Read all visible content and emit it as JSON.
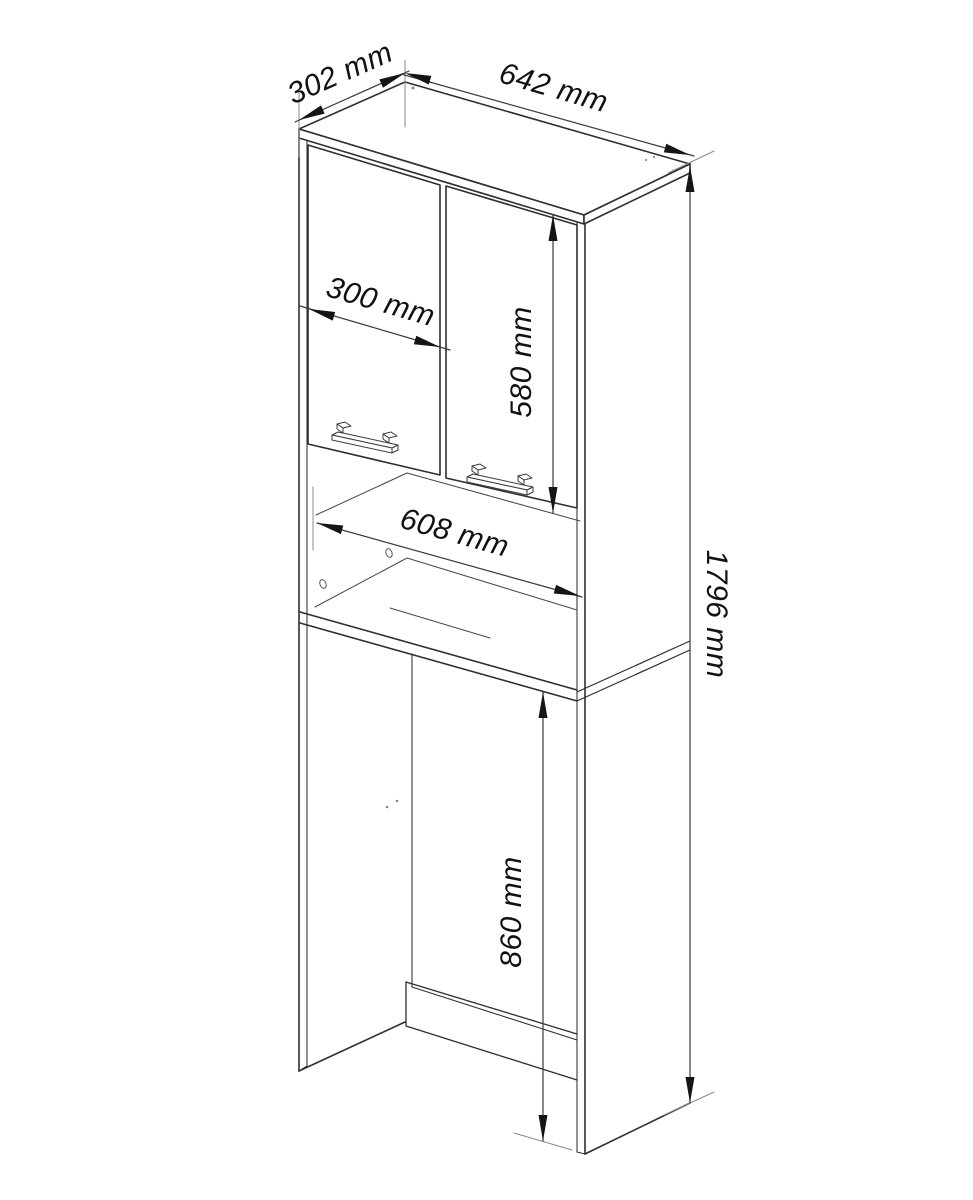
{
  "page": {
    "background": "#ffffff"
  },
  "drawing": {
    "type": "furniture-technical-drawing",
    "subject": "Tall bathroom cabinet for over a washing machine, isometric line drawing",
    "line_color": "#2f2f2f",
    "dimension_text_color": "#111111",
    "dimensions": {
      "top_depth": "302 mm",
      "top_width": "642 mm",
      "door_width": "300 mm",
      "door_height": "580 mm",
      "niche_width": "608 mm",
      "total_height": "1796 mm",
      "opening_height": "860 mm"
    }
  }
}
